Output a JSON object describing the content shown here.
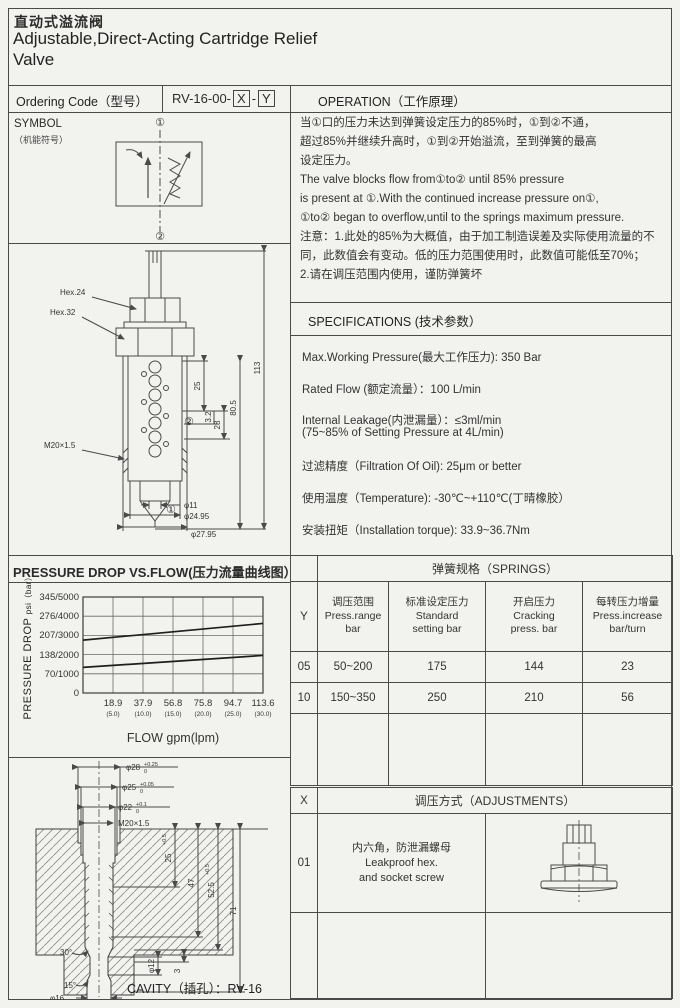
{
  "header": {
    "title_zh": "直动式溢流阀",
    "title_en_1": "Adjustable,Direct-Acting Cartridge Relief",
    "title_en_2": "Valve"
  },
  "ordering": {
    "label": "Ordering Code（型号）",
    "prefix": "RV-16-00-",
    "x": "X",
    "sep": "-",
    "y": "Y"
  },
  "symbol": {
    "title": "SYMBOL",
    "subtitle": "（机能符号）",
    "port_top": "①",
    "port_bottom": "②"
  },
  "valve_drawing": {
    "hex24": "Hex.24",
    "hex32": "Hex.32",
    "thread": "M20×1.5",
    "port1": "①",
    "port2": "②",
    "dim_25": "25",
    "dim_3_2": "3.2",
    "dim_28": "28",
    "dim_80_5": "80.5",
    "dim_113": "113",
    "dia_11": "φ11",
    "dia_24_95": "φ24.95",
    "dia_27_95": "φ27.95"
  },
  "operation": {
    "title": "OPERATION（工作原理）",
    "lines": [
      "当①口的压力未达到弹簧设定压力的85%时，①到②不通，",
      "超过85%并继续升高时，①到②开始溢流，至到弹簧的最高",
      "设定压力。",
      "The valve blocks flow from①to② until 85% pressure",
      "is present at ①.With the continued increase pressure on①,",
      "①to② began to overflow,until to the springs maximum pressure.",
      "注意：1.此处的85%为大概值，由于加工制造误差及实际使用流量的不",
      "同，此数值会有变动。低的压力范围使用时，此数值可能低至70%；",
      "2.请在调压范围内使用，谨防弹簧坏"
    ]
  },
  "specifications": {
    "title": "SPECIFICATIONS (技术参数）",
    "items": [
      "Max.Working Pressure(最大工作压力): 350 Bar",
      "Rated Flow (额定流量）：100 L/min",
      "Internal Leakage(内泄漏量）：≤3ml/min",
      "(75~85% of Setting Pressure at 4L/min)",
      "过滤精度（Filtration Of Oil):    25μm or better",
      "使用温度（Temperature):   -30℃~+110℃(丁晴橡胶）",
      "安装扭矩（Installation torque):   33.9~36.7Nm"
    ]
  },
  "chart": {
    "title": "PRESSURE DROP VS.FLOW(压力流量曲线图）",
    "ylabel": "PRESSURE DROP",
    "yunit": "psi（bar）",
    "xlabel": "FLOW gpm(lpm)",
    "yticks": [
      "345/5000",
      "276/4000",
      "207/3000",
      "138/2000",
      "70/1000",
      "0"
    ],
    "xticks": [
      "18.9",
      "37.9",
      "56.8",
      "75.8",
      "94.7",
      "113.6"
    ],
    "xticks_lpm": [
      "(5.0)",
      "(10.0)",
      "(15.0)",
      "(20.0)",
      "(25.0)",
      "(30.0)"
    ]
  },
  "chart_data": {
    "type": "line",
    "title": "PRESSURE DROP VS.FLOW(压力流量曲线图）",
    "xlabel": "FLOW gpm(lpm)",
    "ylabel": "PRESSURE DROP psi（bar）",
    "x": [
      0,
      113.6
    ],
    "xlim": [
      0,
      113.6
    ],
    "ylim": [
      0,
      345
    ],
    "y_unit": "bar",
    "grid": true,
    "legend": "none",
    "series": [
      {
        "name": "upper curve (spring 10)",
        "values": [
          190,
          250
        ]
      },
      {
        "name": "lower curve (spring 05)",
        "values": [
          92,
          135
        ]
      }
    ]
  },
  "springs": {
    "y_col": "Y",
    "title": "弹簧规格（SPRINGS）",
    "headers": [
      [
        "调压范围",
        "Press.range",
        "bar"
      ],
      [
        "标准设定压力",
        "Standard",
        "setting bar"
      ],
      [
        "开启压力",
        "Cracking",
        "press. bar"
      ],
      [
        "每转压力增量",
        "Press.increase",
        "bar/turn"
      ]
    ],
    "rows": [
      [
        "05",
        "50~200",
        "175",
        "144",
        "23"
      ],
      [
        "10",
        "150~350",
        "250",
        "210",
        "56"
      ]
    ]
  },
  "adjustments": {
    "x_col": "X",
    "title": "调压方式（ADJUSTMENTS）",
    "rows": [
      {
        "code": "01",
        "desc_zh": "内六角，防泄漏螺母",
        "desc_en1": "Leakproof hex.",
        "desc_en2": "and socket screw"
      }
    ]
  },
  "cavity": {
    "caption": "CAVITY（插孔）：RV-16",
    "top_dims": [
      {
        "base": "φ28",
        "sup": "+0.25",
        "sub": "0"
      },
      {
        "base": "φ25",
        "sup": "+0.05",
        "sub": "0"
      },
      {
        "base": "φ22",
        "sup": "+0.1",
        "sub": "0"
      },
      {
        "base": "M20×1.5",
        "sup": "",
        "sub": ""
      }
    ],
    "side_dims": [
      {
        "base": "25",
        "sup": "+0.5",
        "sub": "0"
      },
      {
        "base": "47",
        "sup": "",
        "sub": ""
      },
      {
        "base": "52.5",
        "sup": "+0.5",
        "sub": "0"
      },
      {
        "base": "71",
        "sup": "",
        "sub": ""
      },
      {
        "base": "3",
        "sup": "",
        "sub": ""
      }
    ],
    "dia12": "φ12",
    "dia16": "φ16",
    "angle30": "30°",
    "angle15": "15°"
  }
}
